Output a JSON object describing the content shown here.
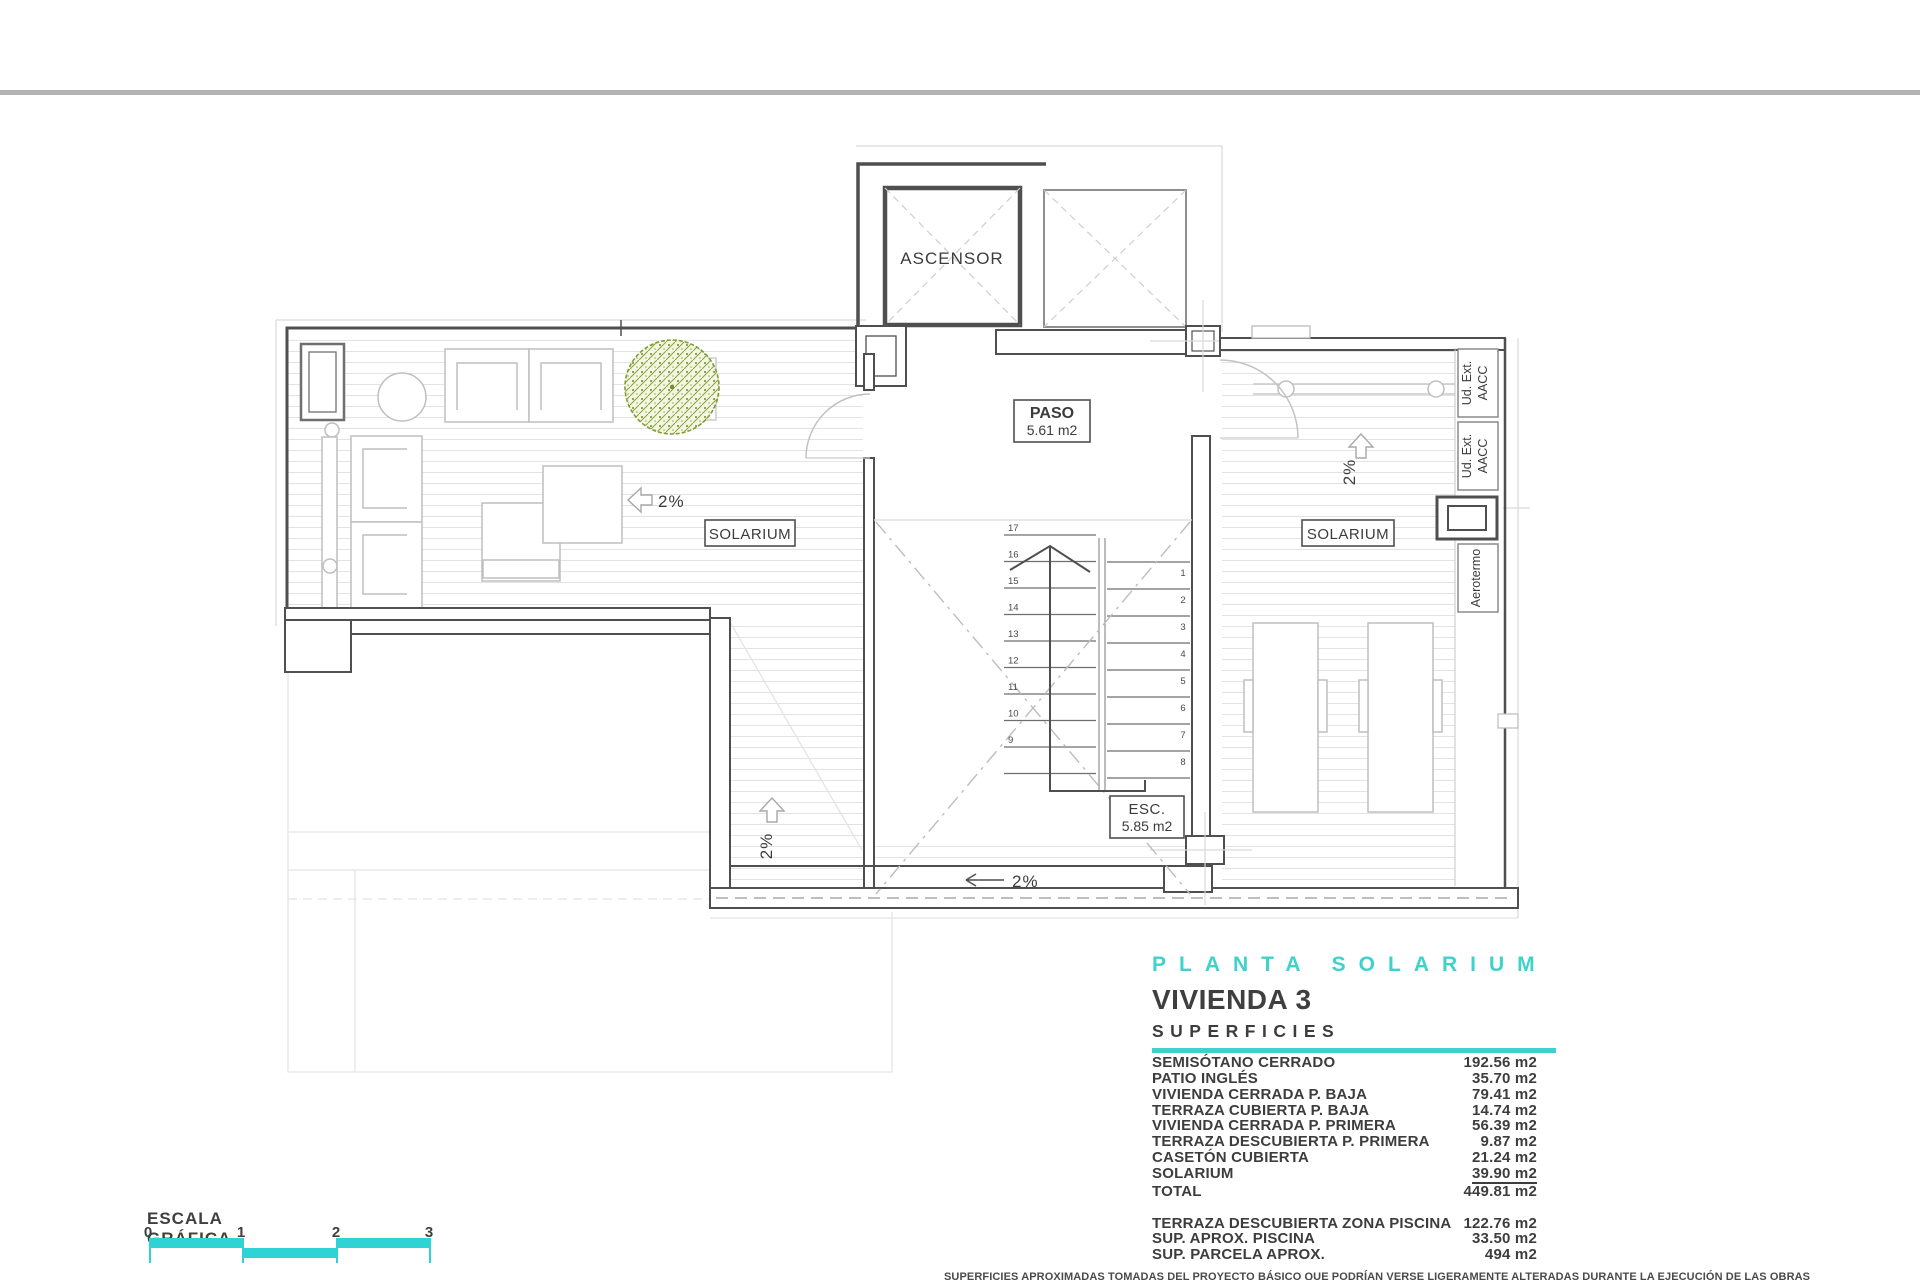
{
  "plan": {
    "labels": {
      "ascensor": "ASCENSOR",
      "paso_title": "PASO",
      "paso_area": "5.61 m2",
      "esc_title": "ESC.",
      "esc_area": "5.85 m2",
      "solarium_left": "SOLARIUM",
      "solarium_right": "SOLARIUM",
      "slope_left": "2%",
      "slope_mid": "2%",
      "slope_bottom": "2%",
      "slope_right": "2%",
      "aacc_line1": "Ud. Ext.",
      "aacc_line2": "AACC",
      "aerotermo": "Aerotermo"
    },
    "stairs": {
      "left_steps": [
        "17",
        "16",
        "15",
        "14",
        "13",
        "12",
        "11",
        "10",
        "9"
      ],
      "right_steps": [
        "1",
        "2",
        "3",
        "4",
        "5",
        "6",
        "7",
        "8"
      ]
    }
  },
  "title_block": {
    "plan_title": "PLANTA SOLARIUM",
    "unit_title": "VIVIENDA 3",
    "section_title": "SUPERFICIES",
    "surfaces": [
      {
        "label": "SEMISÓTANO CERRADO",
        "value": "192.56 m2"
      },
      {
        "label": "PATIO INGLÉS",
        "value": "35.70 m2"
      },
      {
        "label": "VIVIENDA CERRADA P. BAJA",
        "value": "79.41 m2"
      },
      {
        "label": "TERRAZA CUBIERTA P. BAJA",
        "value": "14.74 m2"
      },
      {
        "label": "VIVIENDA CERRADA P. PRIMERA",
        "value": "56.39 m2"
      },
      {
        "label": "TERRAZA DESCUBIERTA P. PRIMERA",
        "value": "9.87 m2"
      },
      {
        "label": "CASETÓN CUBIERTA",
        "value": "21.24 m2"
      },
      {
        "label": "SOLARIUM",
        "value": "39.90 m2",
        "underline": true
      },
      {
        "label": "TOTAL",
        "value": "449.81 m2"
      }
    ],
    "extra_surfaces": [
      {
        "label": "TERRAZA DESCUBIERTA  ZONA PISCINA",
        "value": "122.76 m2"
      },
      {
        "label": "SUP.  APROX.  PISCINA",
        "value": "33.50 m2"
      },
      {
        "label": "SUP. PARCELA APROX.",
        "value": "494 m2"
      }
    ]
  },
  "scale_bar": {
    "title": "ESCALA GRÁFICA",
    "ticks": [
      "0",
      "1",
      "2",
      "3"
    ]
  },
  "disclaimer": "SUPERFICIES APROXIMADAS TOMADAS DEL PROYECTO BÁSICO QUE PODRÍAN VERSE LIGERAMENTE ALTERADAS DURANTE LA EJECUCIÓN DE LAS OBRAS",
  "colors": {
    "teal": "#3fd2ca",
    "cyan_bar": "#2fd3d3",
    "wall": "#4f4f4f",
    "tree_green": "#7f9d33"
  }
}
